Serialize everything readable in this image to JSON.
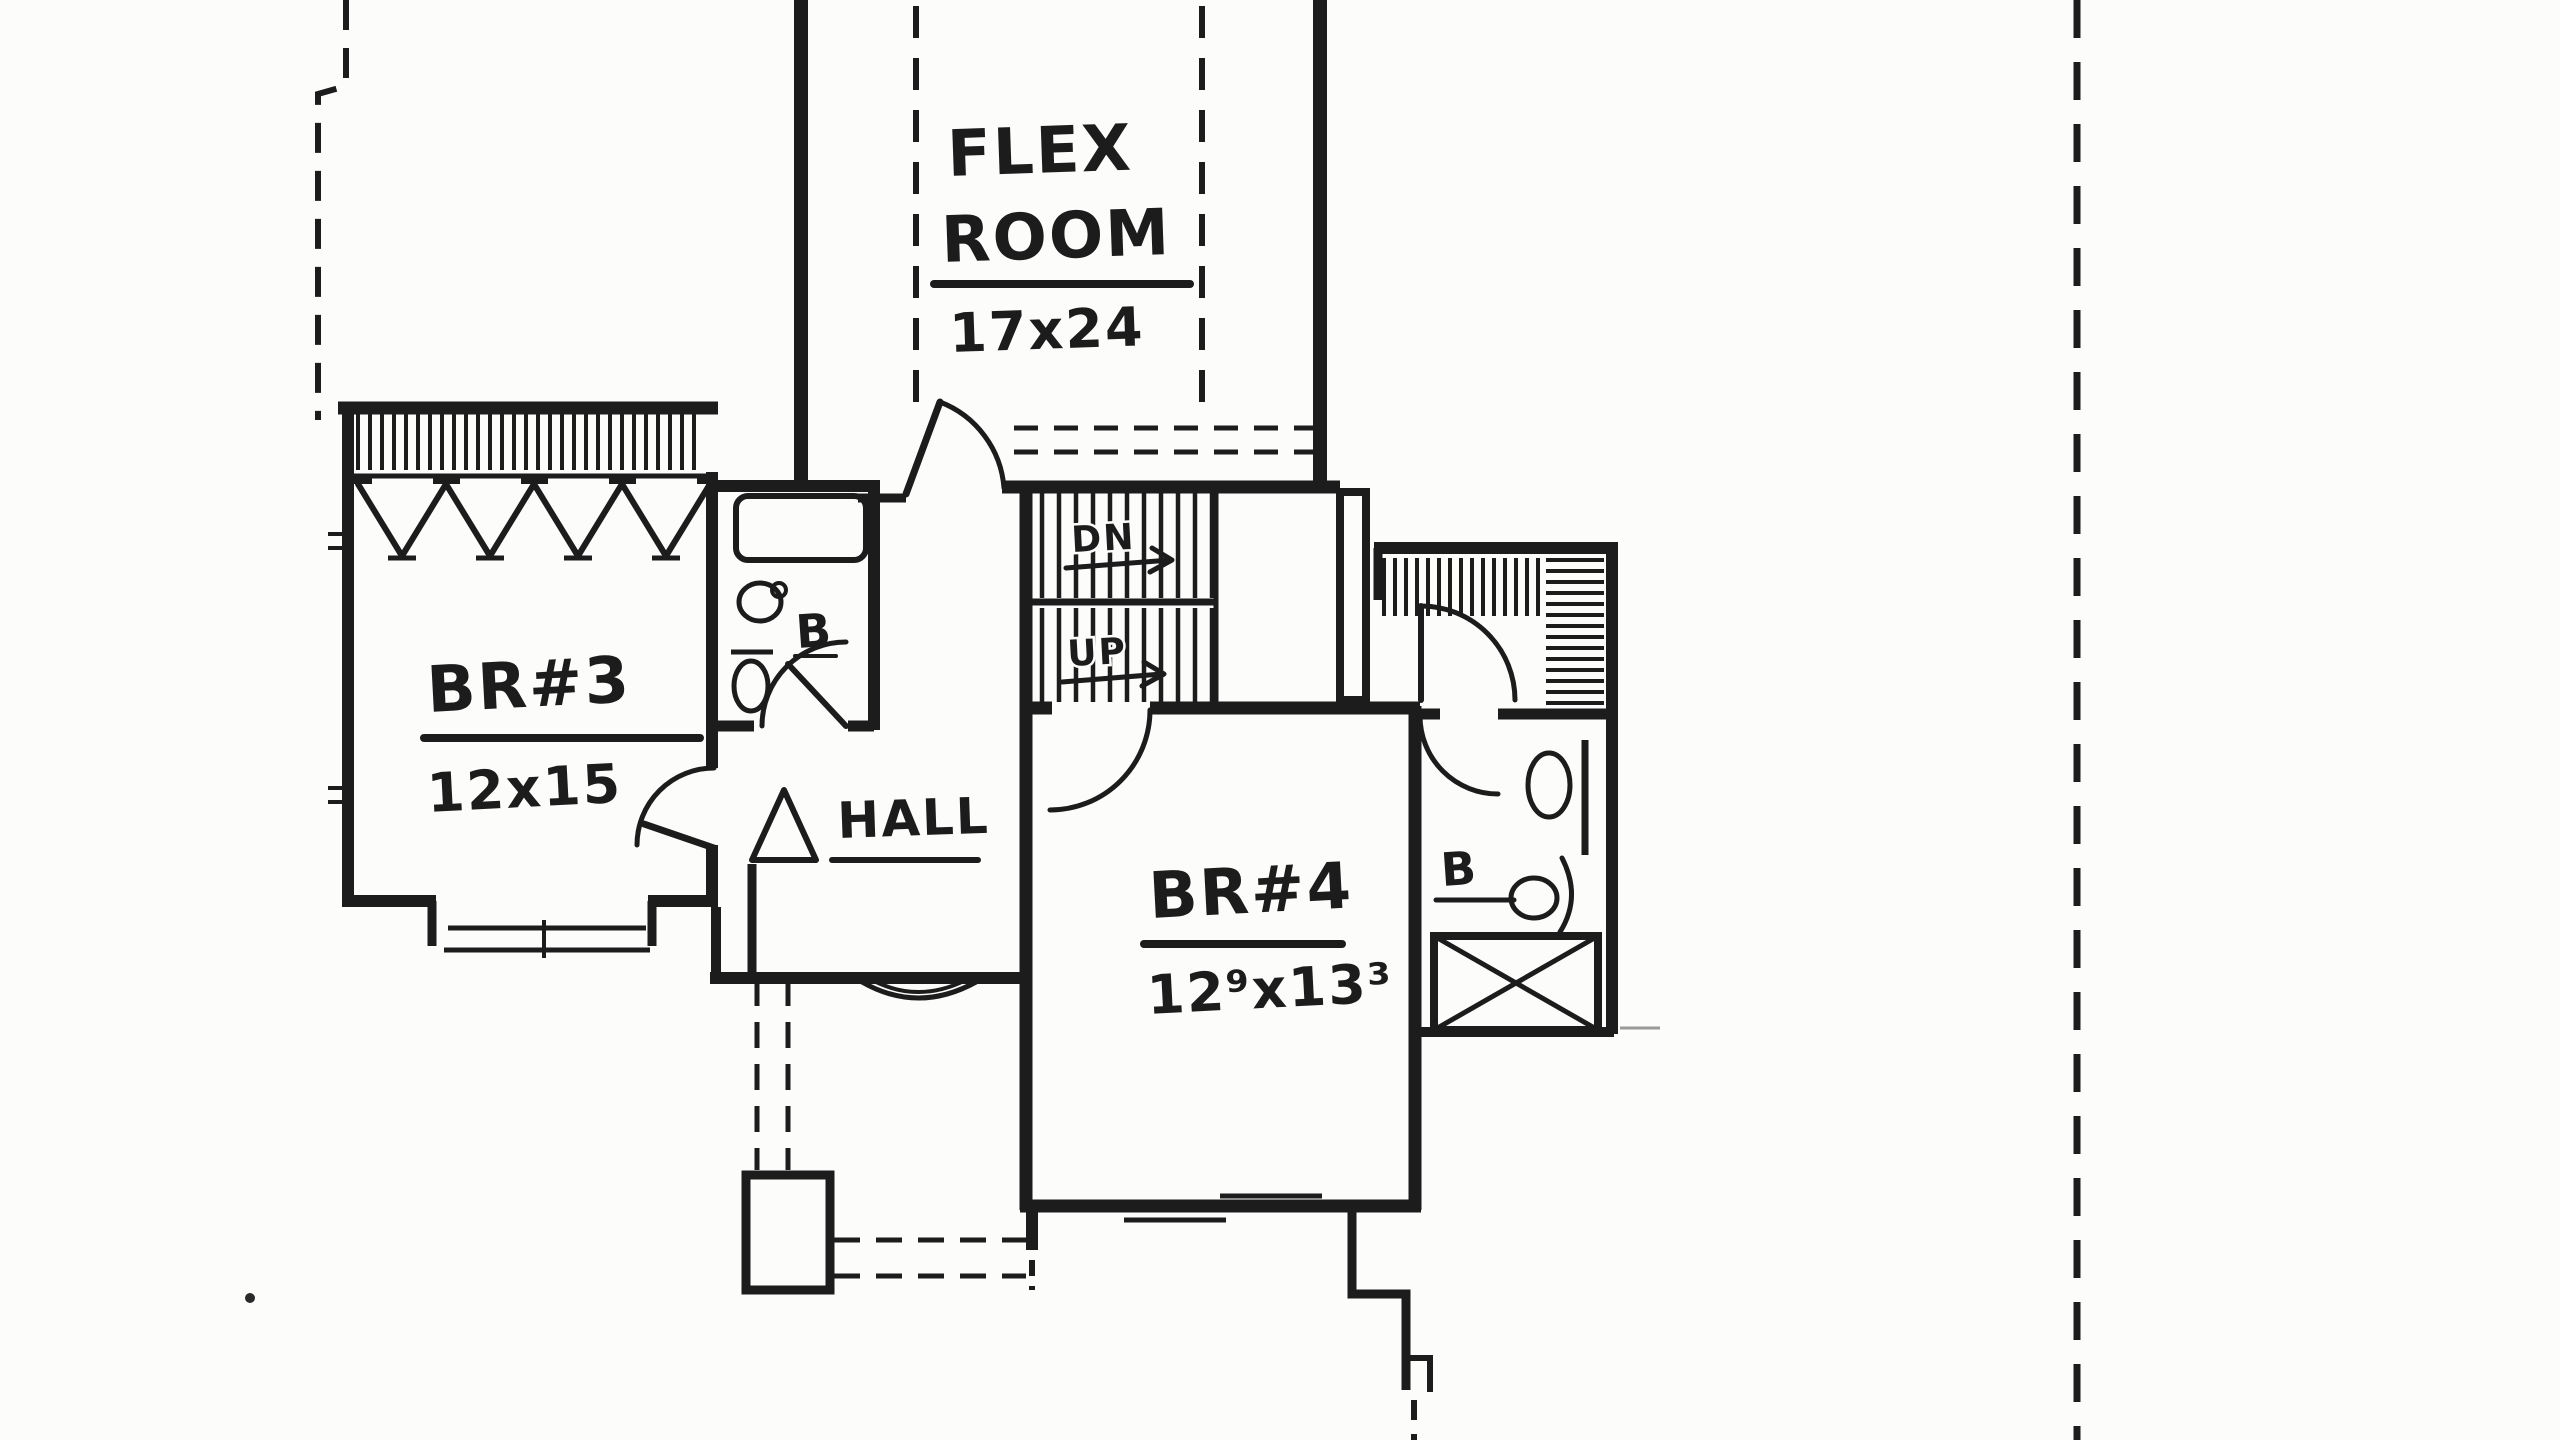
{
  "plan": {
    "flex_room": {
      "name_line1": "FLEX",
      "name_line2": "ROOM",
      "dims": "17x24"
    },
    "bedroom3": {
      "name": "BR#3",
      "dims": "12x15"
    },
    "bedroom4": {
      "name": "BR#4",
      "dims": "12⁹x13³"
    },
    "hall": {
      "name": "HALL"
    },
    "stairs": {
      "down_label": "DN",
      "up_label": "UP"
    },
    "bath_middle": {
      "label": "B"
    },
    "bath_right": {
      "label": "B"
    },
    "colors": {
      "ink": "#1c1c1c",
      "paper": "#fcfcfb"
    }
  }
}
